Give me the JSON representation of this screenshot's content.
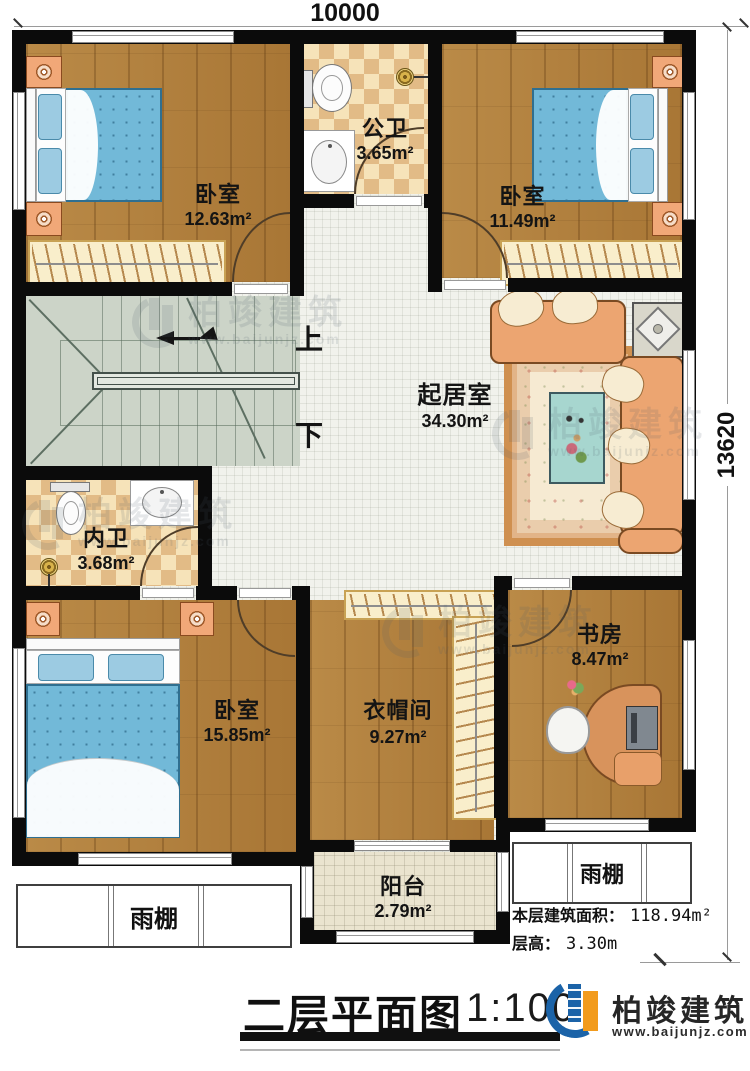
{
  "title_block": {
    "title": "二层平面图",
    "scale": "1:100"
  },
  "logo": {
    "name": "柏竣建筑",
    "website": "www.baijunjz.com"
  },
  "watermark": {
    "name": "柏竣建筑",
    "website": "www.baijunjz.com"
  },
  "dimensions": {
    "width": "10000",
    "height": "13620"
  },
  "info": {
    "floor_area_label": "本层建筑面积：",
    "floor_area_value": "118.94m²",
    "floor_height_label": "层高：",
    "floor_height_value": "3.30m"
  },
  "stairs": {
    "up_label": "上",
    "down_label": "下"
  },
  "rooms": [
    {
      "name": "卧室",
      "area": "12.63m²"
    },
    {
      "name": "公卫",
      "area": "3.65m²"
    },
    {
      "name": "卧室",
      "area": "11.49m²"
    },
    {
      "name": "起居室",
      "area": "34.30m²"
    },
    {
      "name": "内卫",
      "area": "3.68m²"
    },
    {
      "name": "卧室",
      "area": "15.85m²"
    },
    {
      "name": "衣帽间",
      "area": "9.27m²"
    },
    {
      "name": "书房",
      "area": "8.47m²"
    },
    {
      "name": "阳台",
      "area": "2.79m²"
    }
  ],
  "canopies": {
    "left": "雨棚",
    "right": "雨棚"
  }
}
